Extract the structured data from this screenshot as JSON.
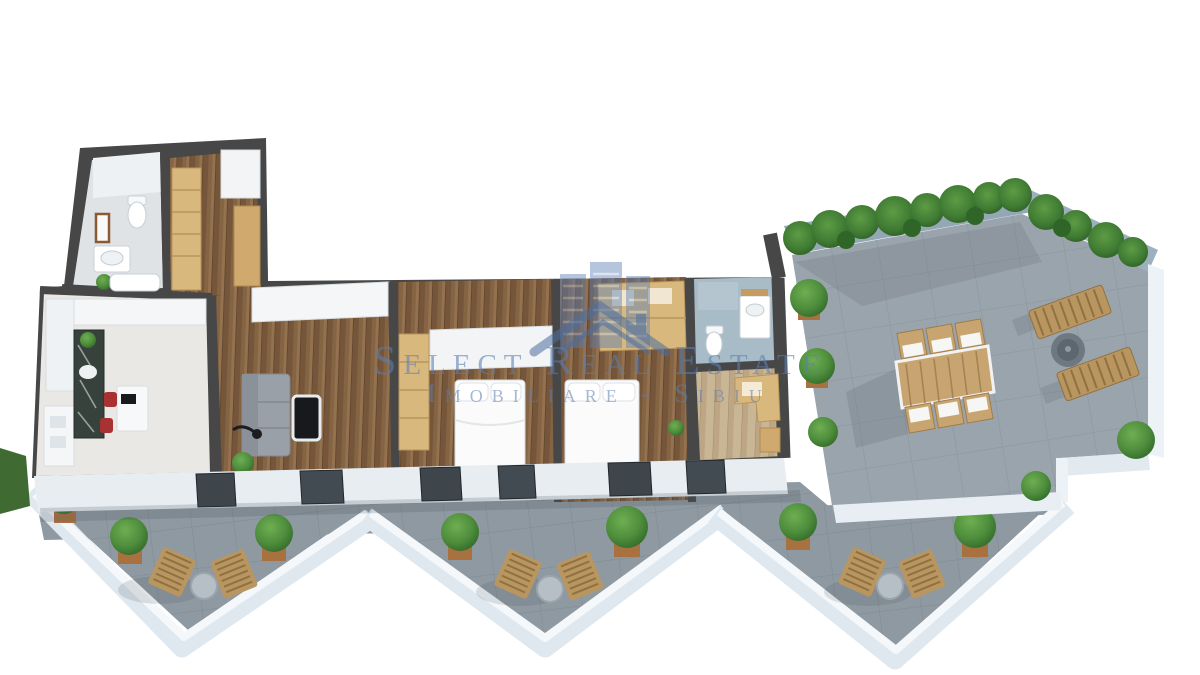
{
  "watermark": {
    "brand_line": "Select Real Estate",
    "sub_line": "Imobiliare - Sibiu",
    "logo": "blue-buildings-and-house-roof",
    "color": "#5a7fb5"
  },
  "scene": {
    "title": "3D apartment floor plan render with wrap-around terrace",
    "rooms": [
      {
        "name": "bathroom-1",
        "furniture": [
          "toilet",
          "sink",
          "mirror",
          "bathtub",
          "plant"
        ]
      },
      {
        "name": "entry-hall",
        "furniture": [
          "wardrobe",
          "closet"
        ]
      },
      {
        "name": "kitchen",
        "furniture": [
          "island-counter",
          "sink",
          "table",
          "red-chairs",
          "white-cabinets"
        ]
      },
      {
        "name": "living-room",
        "furniture": [
          "gray-sofa",
          "coffee-table",
          "floor-lamp",
          "plant",
          "sideboard"
        ]
      },
      {
        "name": "bedroom-1",
        "furniture": [
          "double-bed",
          "wardrobe",
          "closet"
        ]
      },
      {
        "name": "bedroom-2",
        "furniture": [
          "double-bed",
          "wardrobe",
          "plant"
        ]
      },
      {
        "name": "bathroom-2",
        "furniture": [
          "toilet",
          "vanity",
          "mirror"
        ]
      },
      {
        "name": "office",
        "furniture": [
          "desk",
          "shelves"
        ]
      }
    ],
    "terrace": {
      "floor": "gray-stone-tiles",
      "furniture": [
        "wood-dining-table",
        "six-dining-chairs",
        "two-sun-loungers",
        "round-fire-pit"
      ],
      "plants": {
        "hedge_trees": 12,
        "corner_bushes": 5
      }
    },
    "balconies": [
      {
        "name": "balcony-left",
        "items": [
          "two-wood-chairs",
          "round-ottoman",
          "three-potted-bushes"
        ]
      },
      {
        "name": "balcony-middle",
        "items": [
          "two-wood-chairs",
          "round-ottoman",
          "two-potted-bushes"
        ]
      },
      {
        "name": "balcony-right",
        "items": [
          "two-wood-chairs",
          "round-ottoman",
          "three-potted-bushes"
        ]
      }
    ],
    "palette": {
      "wall": "#474747",
      "wood_floor": "#856444",
      "terrace_floor": "#9aa4ac",
      "parapet": "#edf2f7",
      "greenery": "#4f8f3d",
      "wardrobe": "#d9b87e",
      "accent_red": "#a83232",
      "bath_floor": "#a8bcc8"
    }
  }
}
